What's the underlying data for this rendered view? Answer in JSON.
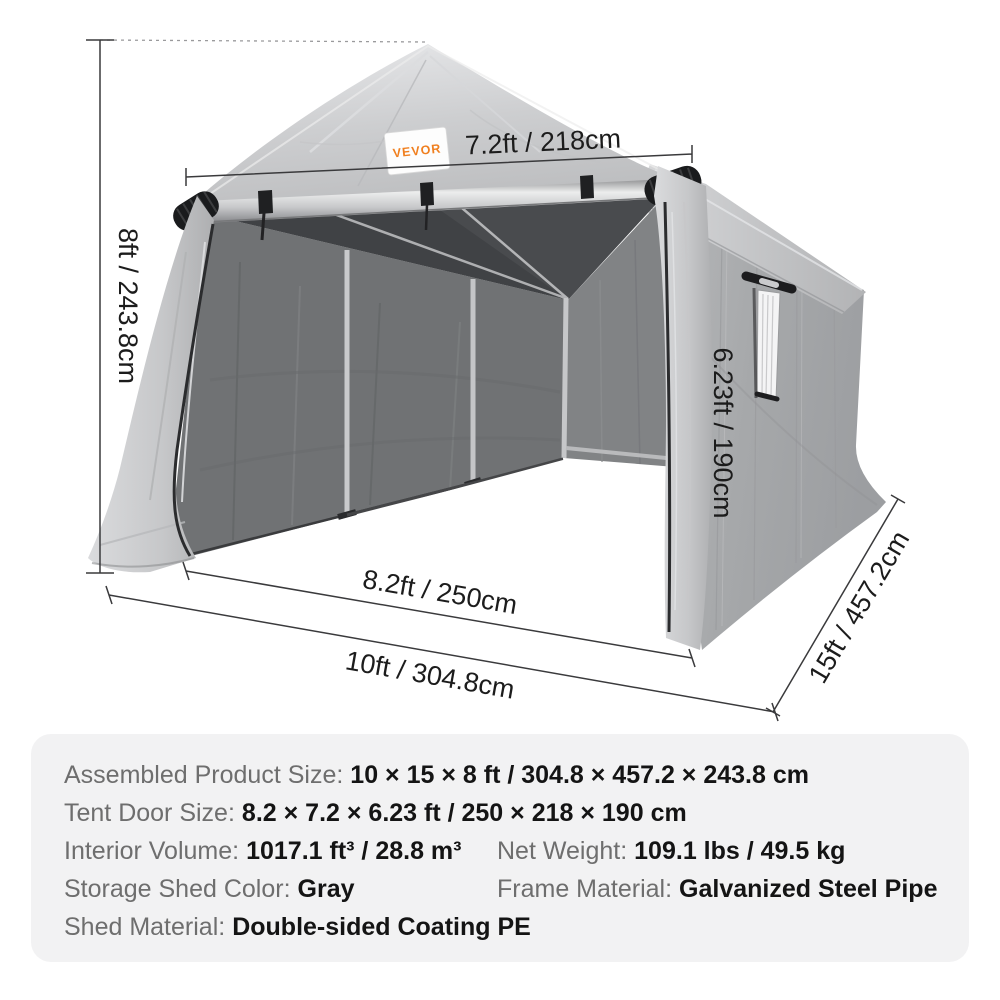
{
  "product_diagram": {
    "brand_label": "VEVOR",
    "dimensions": {
      "door_top_width": "7.2ft / 218cm",
      "overall_height": "8ft / 243.8cm",
      "door_height": "6.23ft / 190cm",
      "door_bottom_width": "8.2ft / 250cm",
      "overall_width": "10ft / 304.8cm",
      "overall_depth": "15ft / 457.2cm"
    }
  },
  "spec_panel": {
    "assembled_size": {
      "label": "Assembled Product Size:",
      "value": "10 × 15 × 8 ft / 304.8 × 457.2 × 243.8 cm"
    },
    "door_size": {
      "label": "Tent Door Size:",
      "value": "8.2 × 7.2 × 6.23 ft / 250 × 218 × 190 cm"
    },
    "interior_volume": {
      "label": "Interior Volume:",
      "value": "1017.1 ft³ / 28.8 m³"
    },
    "net_weight": {
      "label": "Net Weight:",
      "value": "109.1 lbs / 49.5 kg"
    },
    "shed_color": {
      "label": "Storage Shed Color:",
      "value": "Gray"
    },
    "frame_material": {
      "label": "Frame Material:",
      "value": "Galvanized Steel Pipe"
    },
    "shed_material": {
      "label": "Shed Material:",
      "value": "Double-sided Coating PE"
    }
  },
  "colors": {
    "brand_orange": "#f07f1f",
    "panel_bg": "#f2f2f3",
    "label_gray": "#6e6e6e",
    "value_black": "#141414",
    "dimension_line": "#3a3a3c"
  }
}
